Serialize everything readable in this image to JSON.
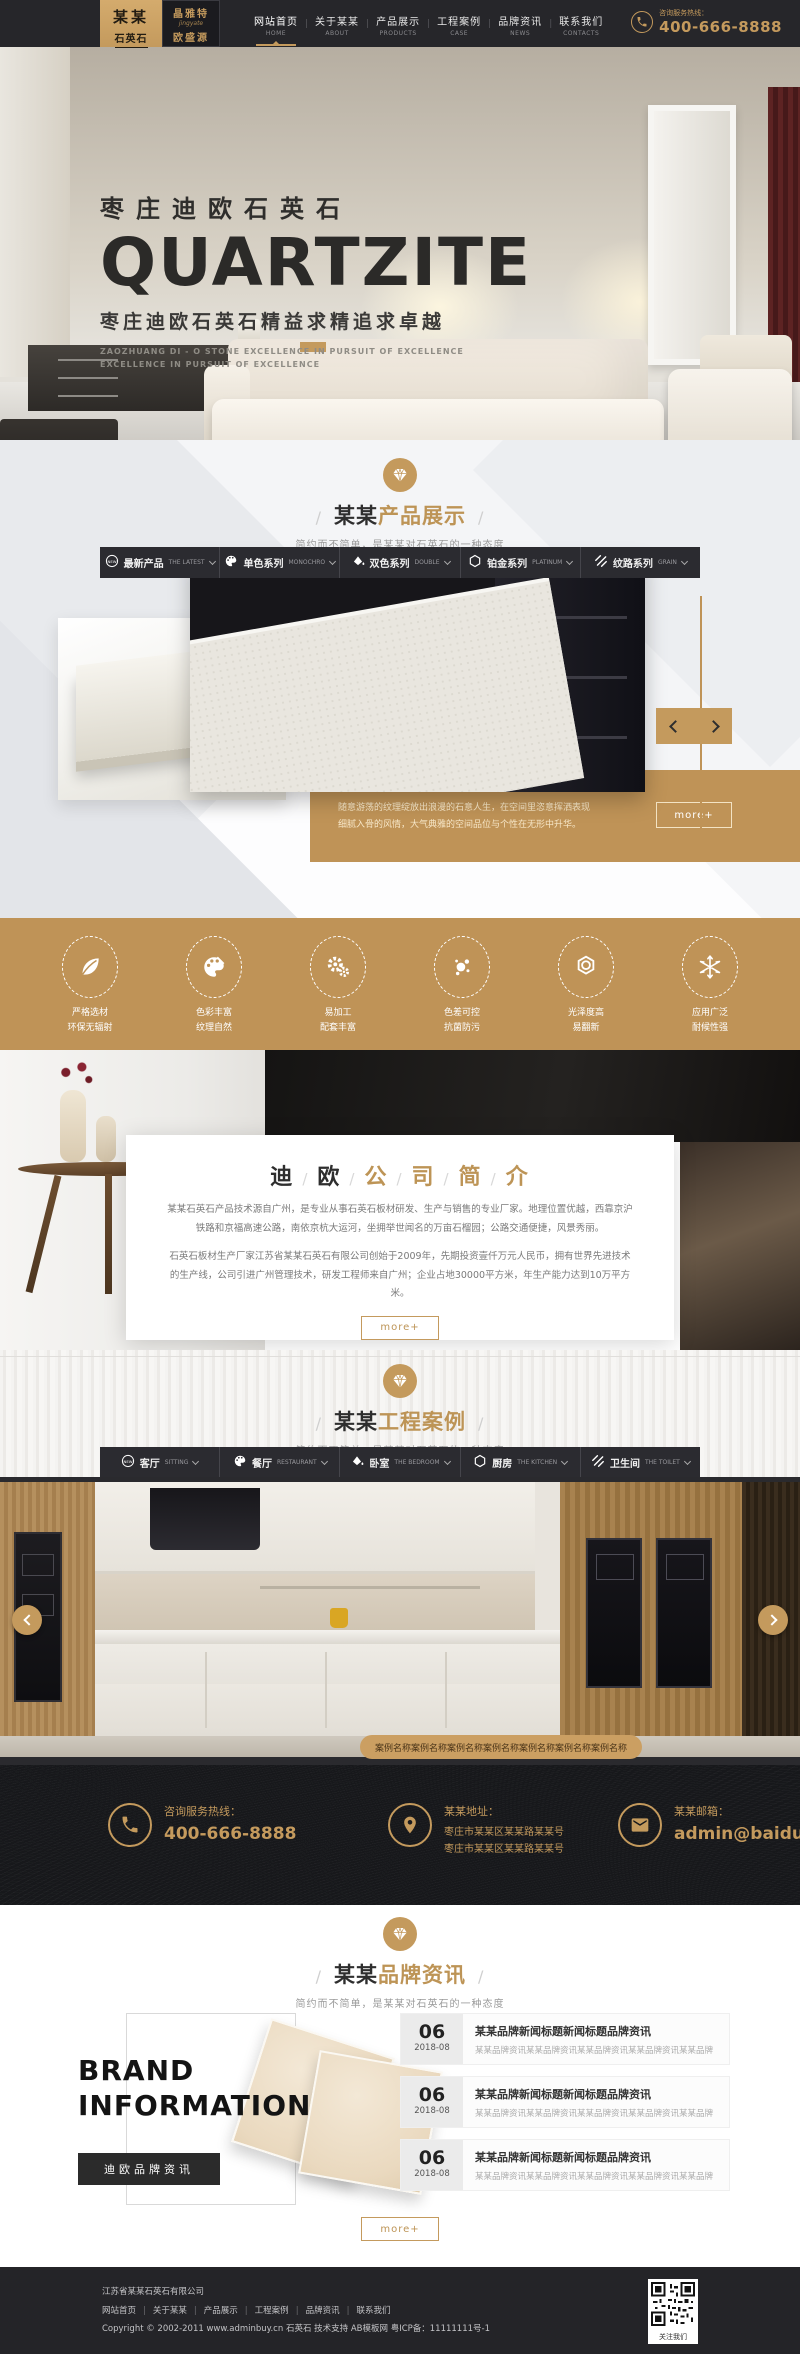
{
  "colors": {
    "accent": "#c49a5d",
    "gold_dark": "#bf9357",
    "header_bg": "#26262a",
    "footer_bg": "#242428"
  },
  "header": {
    "logo": {
      "name_top": "某某",
      "name_bottom": "石英石",
      "brand1": "晶雅特",
      "brand1_en": "jingyate",
      "brand2": "欧盛源"
    },
    "nav": [
      {
        "zh": "网站首页",
        "en": "HOME"
      },
      {
        "zh": "关于某某",
        "en": "ABOUT"
      },
      {
        "zh": "产品展示",
        "en": "PRODUCTS"
      },
      {
        "zh": "工程案例",
        "en": "CASE"
      },
      {
        "zh": "品牌资讯",
        "en": "NEWS"
      },
      {
        "zh": "联系我们",
        "en": "CONTACTS"
      }
    ],
    "hotline_label": "咨询服务热线：",
    "hotline_number": "400-666-8888"
  },
  "hero": {
    "title_zh": "枣庄迪欧石英石",
    "title_en": "QUARTZITE",
    "subtitle": "枣庄迪欧石英石精益求精追求卓越",
    "caption1": "ZAOZHUANG DI - O STONE EXCELLENCE IN PURSUIT OF EXCELLENCE",
    "caption2": "EXCELLENCE IN PURSUIT OF EXCELLENCE"
  },
  "products": {
    "title_prefix": "某某",
    "title_main": "产品展示",
    "subtitle": "简约而不简单，是某某对石英石的一种态度",
    "tabs": [
      {
        "zh": "最新产品",
        "en": "THE LATEST",
        "icon": "new-badge-icon"
      },
      {
        "zh": "单色系列",
        "en": "MONOCHRO",
        "icon": "palette-icon"
      },
      {
        "zh": "双色系列",
        "en": "DOUBLE",
        "icon": "paint-bucket-icon"
      },
      {
        "zh": "铂金系列",
        "en": "PLATINUM",
        "icon": "hexagon-icon"
      },
      {
        "zh": "纹路系列",
        "en": "GRAIN",
        "icon": "stripes-icon"
      }
    ],
    "caption1": "随意游荡的纹理绽放出浪漫的石意人生，在空间里恣意挥洒表现",
    "caption2": "细腻入骨的风情，大气典雅的空间品位与个性在无形中升华。",
    "more_label": "more+"
  },
  "features": {
    "items": [
      {
        "icon": "leaf-icon",
        "line1": "严格选材",
        "line2": "环保无辐射"
      },
      {
        "icon": "palette-icon",
        "line1": "色彩丰富",
        "line2": "纹理自然"
      },
      {
        "icon": "gears-icon",
        "line1": "易加工",
        "line2": "配套丰富"
      },
      {
        "icon": "dots-icon",
        "line1": "色差可控",
        "line2": "抗菌防污"
      },
      {
        "icon": "gem-icon",
        "line1": "光泽度高",
        "line2": "易翻新"
      },
      {
        "icon": "snowflake-icon",
        "line1": "应用广泛",
        "line2": "耐候性强"
      }
    ]
  },
  "about": {
    "chars": [
      "迪",
      "欧",
      "公",
      "司",
      "简",
      "介"
    ],
    "para1": "某某石英石产品技术源自广州，是专业从事石英石板材研发、生产与销售的专业厂家。地理位置优越，西靠京沪铁路和京福高速公路，南依京杭大运河，坐拥举世闻名的万亩石榴园；公路交通便捷，风景秀丽。",
    "para2": "石英石板材生产厂家江苏省某某石英石有限公司创始于2009年，先期投资壹仟万元人民币，拥有世界先进技术的生产线，公司引进广州管理技术，研发工程师来自广州；企业占地30000平方米，年生产能力达到10万平方米。",
    "more_label": "more+"
  },
  "cases": {
    "title_prefix": "某某",
    "title_main": "工程案例",
    "subtitle": "简约而不简单，是某某对石英石的一种态度",
    "tabs": [
      {
        "zh": "客厅",
        "en": "SITTING",
        "icon": "new-badge-icon"
      },
      {
        "zh": "餐厅",
        "en": "RESTAURANT",
        "icon": "palette-icon"
      },
      {
        "zh": "卧室",
        "en": "THE BEDROOM",
        "icon": "paint-bucket-icon"
      },
      {
        "zh": "厨房",
        "en": "THE KITCHEN",
        "icon": "hexagon-icon"
      },
      {
        "zh": "卫生间",
        "en": "THE TOILET",
        "icon": "stripes-icon"
      }
    ],
    "slide_caption": "案例名称案例名称案例名称案例名称案例名称案例名称案例名称"
  },
  "contact": {
    "hotline_label": "咨询服务热线：",
    "hotline_number": "400-666-8888",
    "address_label": "某某地址：",
    "address1": "枣庄市某某区某某路某某号",
    "address2": "枣庄市某某区某某路某某号",
    "email_label": "某某邮箱：",
    "email": "admin@baidu.com"
  },
  "news": {
    "title_prefix": "某某",
    "title_main": "品牌资讯",
    "subtitle": "简约而不简单，是某某对石英石的一种态度",
    "brand_line1": "BRAND",
    "brand_line2": "INFORMATION",
    "brand_button": "迪欧品牌资讯",
    "items": [
      {
        "day": "06",
        "date": "2018-08",
        "title": "某某品牌新闻标题新闻标题品牌资讯",
        "excerpt": "某某品牌资讯某某品牌资讯某某品牌资讯某某品牌资讯某某品牌"
      },
      {
        "day": "06",
        "date": "2018-08",
        "title": "某某品牌新闻标题新闻标题品牌资讯",
        "excerpt": "某某品牌资讯某某品牌资讯某某品牌资讯某某品牌资讯某某品牌"
      },
      {
        "day": "06",
        "date": "2018-08",
        "title": "某某品牌新闻标题新闻标题品牌资讯",
        "excerpt": "某某品牌资讯某某品牌资讯某某品牌资讯某某品牌资讯某某品牌"
      }
    ],
    "more_label": "more+"
  },
  "footer": {
    "company": "江苏省某某石英石有限公司",
    "links": [
      "网站首页",
      "关于某某",
      "产品展示",
      "工程案例",
      "品牌资讯",
      "联系我们"
    ],
    "copyright": "Copyright © 2002-2011 www.adminbuy.cn 石英石 技术支持 AB模板网 粤ICP备：11111111号-1",
    "qr_label": "关注我们"
  }
}
